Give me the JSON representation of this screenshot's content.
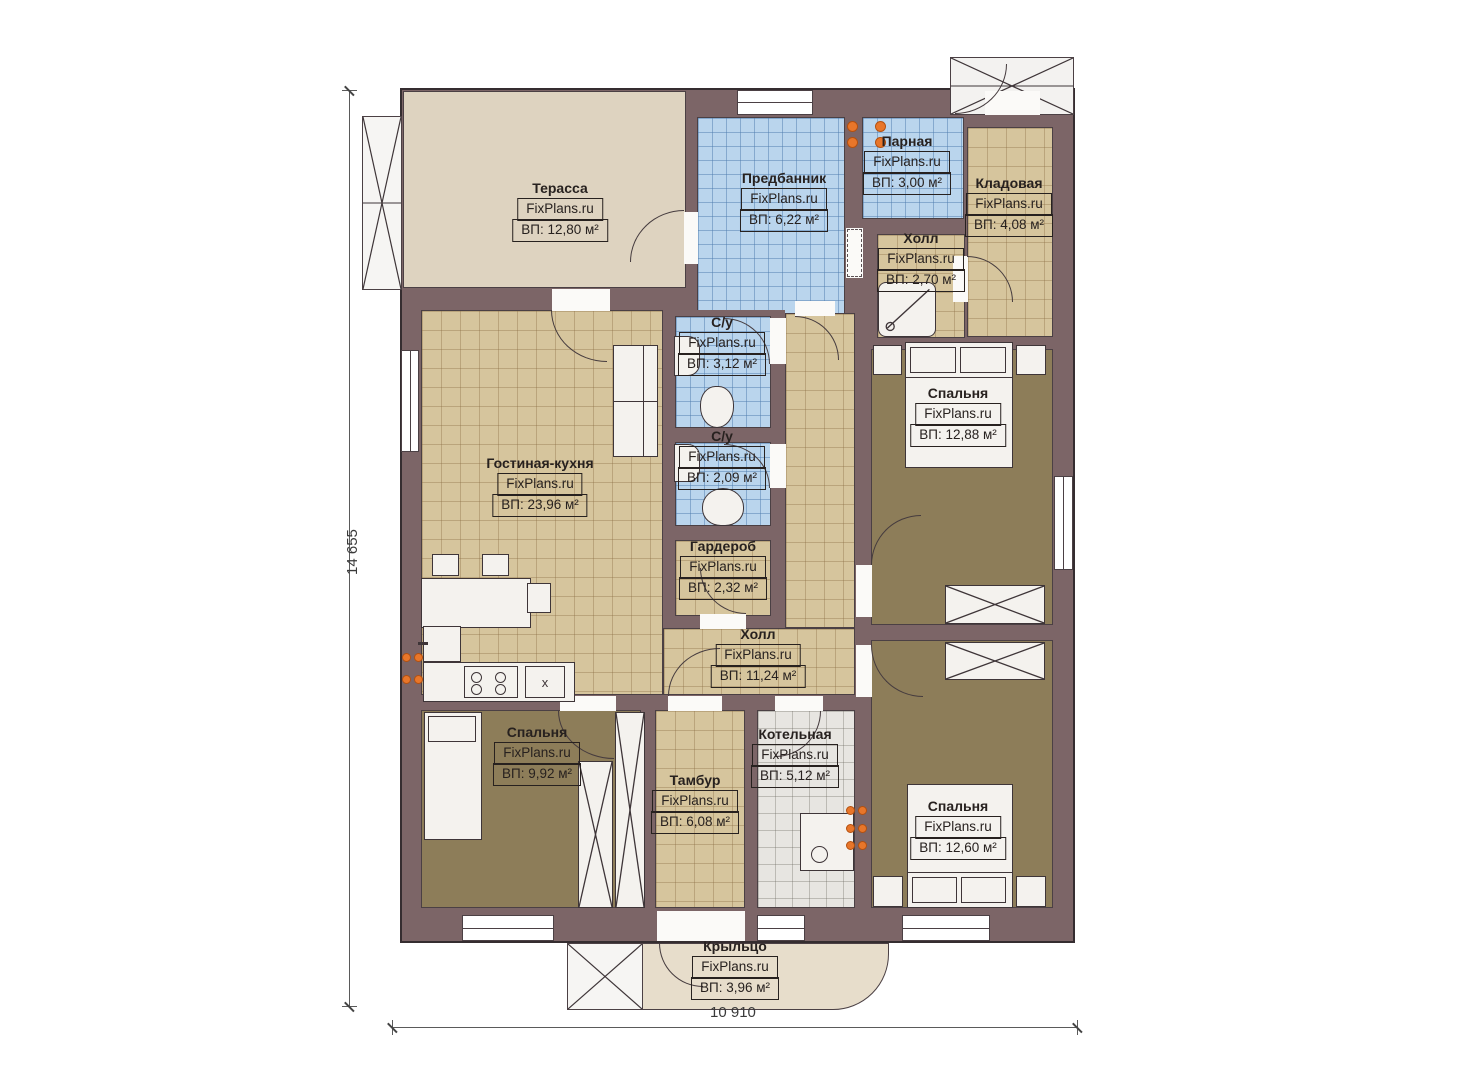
{
  "brand": "FixPlans.ru",
  "dims": {
    "left": "14 655",
    "bottom": "10 910"
  },
  "kitchen_unit_label": "x",
  "rooms": {
    "terrace": {
      "name": "Терасса",
      "area": "ВП: 12,80 м²"
    },
    "predbannik": {
      "name": "Предбанник",
      "area": "ВП: 6,22 м²"
    },
    "parnaya": {
      "name": "Парная",
      "area": "ВП: 3,00 м²"
    },
    "kladovaya": {
      "name": "Кладовая",
      "area": "ВП: 4,08 м²"
    },
    "hall_small": {
      "name": "Холл",
      "area": "ВП: 2,70 м²"
    },
    "su1": {
      "name": "С/у",
      "area": "ВП: 3,12 м²"
    },
    "su2": {
      "name": "С/у",
      "area": "ВП: 2,09 м²"
    },
    "garderob": {
      "name": "Гардероб",
      "area": "ВП: 2,32 м²"
    },
    "living": {
      "name": "Гостиная-кухня",
      "area": "ВП: 23,96 м²"
    },
    "bedroom1": {
      "name": "Спальня",
      "area": "ВП: 12,88 м²"
    },
    "hall_main": {
      "name": "Холл",
      "area": "ВП: 11,24 м²"
    },
    "bedroom2": {
      "name": "Спальня",
      "area": "ВП: 9,92 м²"
    },
    "tambur": {
      "name": "Тамбур",
      "area": "ВП: 6,08 м²"
    },
    "kotelnaya": {
      "name": "Котельная",
      "area": "ВП: 5,12 м²"
    },
    "bedroom3": {
      "name": "Спальня",
      "area": "ВП: 12,60 м²"
    },
    "porch": {
      "name": "Крыльцо",
      "area": "ВП: 3,96 м²"
    }
  },
  "colors": {
    "wall": "#7c6567",
    "terrace_floor": "#ded3c0",
    "tile_tan": "#d6c59d",
    "tile_blue": "#bad5ed",
    "tile_gray": "#e7e5e1",
    "floor_brown": "#8d7d59",
    "porch_floor": "#e7ddcb",
    "accent_orange": "#e8762a"
  }
}
